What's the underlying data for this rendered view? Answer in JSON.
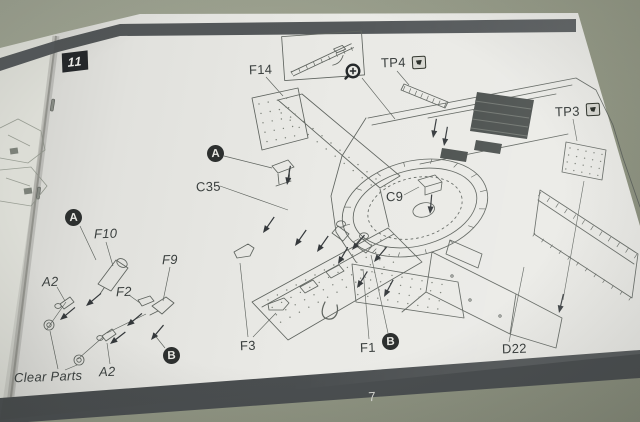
{
  "step": {
    "number": "11"
  },
  "footer": {
    "page_number": "7"
  },
  "labels": {
    "f14": "F14",
    "tp4": "TP4",
    "tp3": "TP3",
    "c35": "C35",
    "c9": "C9",
    "f10": "F10",
    "a2_upper": "A2",
    "f2": "F2",
    "f9": "F9",
    "f3": "F3",
    "f1": "F1",
    "d22": "D22",
    "a2_lower": "A2",
    "clear_parts": "Clear Parts"
  },
  "markers": {
    "a1": "A",
    "a2": "A",
    "b1": "B",
    "b2": "B"
  },
  "icons": {
    "magnifier": "magnifier-circled-plus",
    "tp4_badge": "tape-symbol",
    "tp3_badge": "tape-symbol"
  },
  "colors": {
    "table": "#96998a",
    "paper": "#eaeae6",
    "left_paper": "#dddew6",
    "band": "#54585a",
    "footer_band": "#4a4e50",
    "ink": "#5f645f",
    "label_ink": "#3a3f3e"
  }
}
